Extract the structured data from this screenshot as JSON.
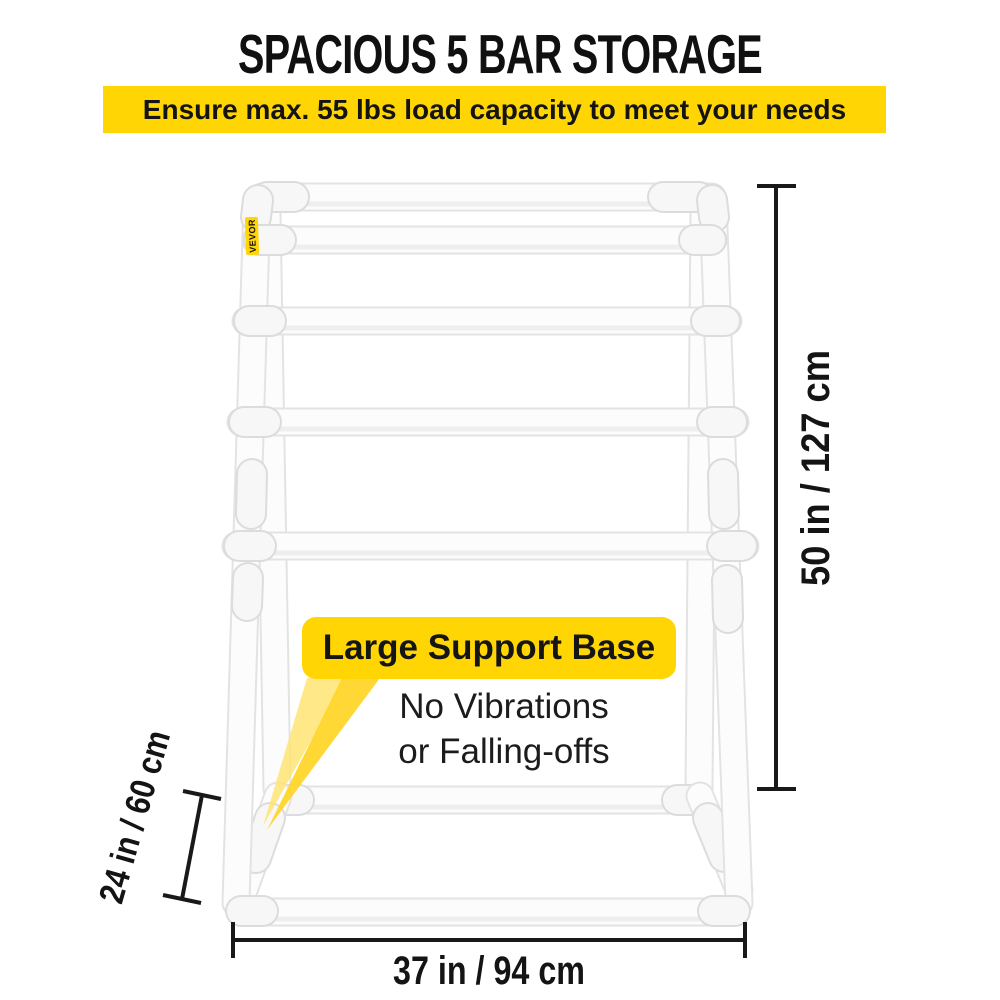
{
  "title": "SPACIOUS 5 BAR STORAGE",
  "banner": {
    "text": "Ensure max. 55 lbs load capacity to meet your needs"
  },
  "brand": {
    "label": "VEVOR"
  },
  "callout": {
    "heading": "Large Support Base",
    "line1": "No Vibrations",
    "line2": "or Falling-offs"
  },
  "dimensions": {
    "height": "50 in / 127 cm",
    "depth": "24 in / 60 cm",
    "width": "37 in / 94 cm"
  },
  "colors": {
    "banner_yellow": "#FFD504",
    "brand_yellow": "#FFD504",
    "beam_light": "#FFE473",
    "beam_dark": "#FFD525",
    "dim": "#191919",
    "text_dark": "#141414",
    "pipe_outline": "#E3E3E3",
    "pipe_fill": "#FCFCFC",
    "pipe_shade": "#ECECEC",
    "fitting_outline": "#DCDCDC",
    "fitting_fill": "#F7F7F7"
  }
}
